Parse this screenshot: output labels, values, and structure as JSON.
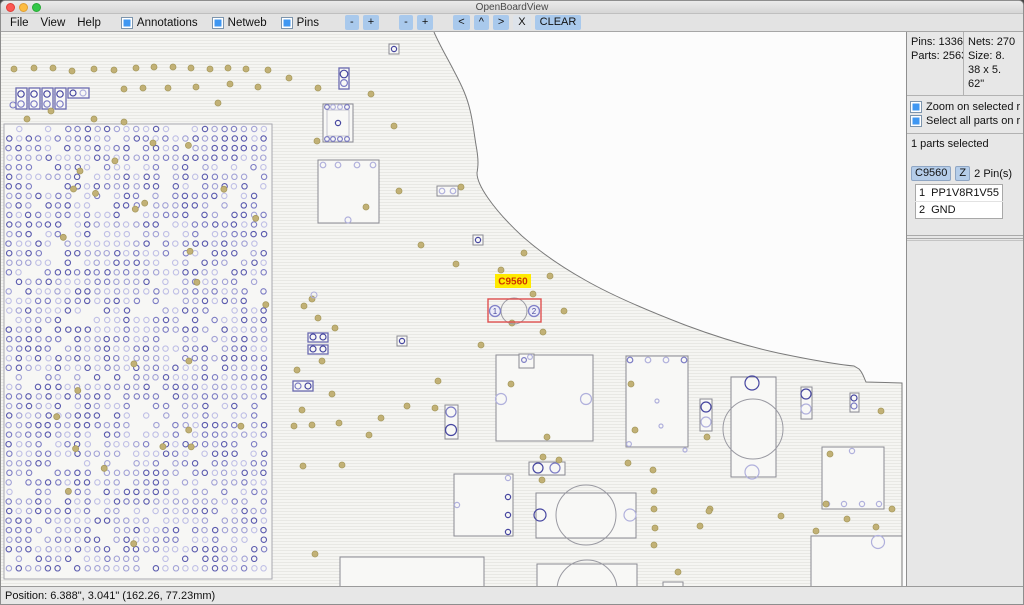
{
  "window": {
    "title": "OpenBoardView"
  },
  "menubar": {
    "menus": [
      "File",
      "View",
      "Help"
    ],
    "toggles": [
      {
        "label": "Annotations",
        "checked": true
      },
      {
        "label": "Netweb",
        "checked": true
      },
      {
        "label": "Pins",
        "checked": true
      }
    ],
    "buttons": [
      "-",
      "+",
      "-",
      "+",
      "<",
      "^",
      ">",
      "X",
      "CLEAR"
    ]
  },
  "sidebar": {
    "stats": {
      "pins": "Pins: 1336",
      "nets": "Nets: 270",
      "parts": "Parts: 2563",
      "size_lines": [
        "Size: 8.",
        "38 x 5.",
        "62\""
      ]
    },
    "options": [
      {
        "label": "Zoom on selected r",
        "checked": true
      },
      {
        "label": "Select all parts on r",
        "checked": true
      }
    ],
    "selection_summary": "1 parts selected",
    "part": {
      "name": "C9560",
      "zoom_button": "Z",
      "pin_count_label": "2 Pin(s)",
      "pins": [
        {
          "num": "1",
          "net": "PP1V8R1V55"
        },
        {
          "num": "2",
          "net": "GND"
        }
      ]
    }
  },
  "statusbar": {
    "position": "Position: 6.388\", 3.041\" (162.26, 77.23mm)"
  },
  "colors": {
    "accent_blue": "#3f97f2",
    "toolbar_button": "#a9c9ec",
    "selection_red": "#e05050",
    "label_yellow": "#ffea00",
    "label_text": "#cc3300",
    "via_fill": "#c2b176",
    "via_stroke": "#a79a5e"
  },
  "board": {
    "width": 905,
    "height": 556,
    "outside_bg": "#fcfcfc",
    "hatch": {
      "base": "#f5f5f2",
      "line": "#e8e8e4"
    },
    "edge_stroke": "#7a7a7a",
    "fill_path": "M0,0 L433,0 C439,14 447,27 453,39 C461,54 466,65 469,78 C472,90 473,101 475,113 C478,129 477,135 476,141 C476,148 480,156 487,166 C496,179 507,191 521,204 C538,219 559,234 584,248 C612,264 645,278 684,293 C716,305 745,314 777,321 C801,326 831,332 853,334 L858,337 C862,341 863,346 865,350 L901,351 L901,556 L0,556 Z",
    "edge_path": "M433,0 C439,14 447,27 453,39 C461,54 466,65 469,78 C472,90 473,101 475,113 C478,129 477,135 476,141 C476,148 480,156 487,166 C496,179 507,191 521,204 C538,219 559,234 584,248 C612,264 645,278 684,293 C716,305 745,314 777,321 C801,326 831,332 853,334 L858,337 C862,341 863,346 865,350 L901,351 L901,556",
    "shade_colors": {
      "d": "#4646a0",
      "m": "#7c7cc4",
      "l": "#b0b0dc",
      "g": "#9a9aa2"
    },
    "component_fill": "#f8f8f6",
    "component_stroke_gray": "#8a8a93",
    "component_stroke_blue": "#6a6ab0",
    "bga": {
      "x": 3,
      "y": 92,
      "w": 268,
      "h": 455,
      "cols": 27,
      "rows": 47,
      "sx": 9.8,
      "sy": 9.55,
      "r": 2.7,
      "skip": 0.16,
      "seed": 1234,
      "via_count": 24,
      "fill": "#f7f7f5",
      "stroke": "#a8a8b0",
      "grid_colors": [
        "#5a5aae",
        "#7d7dc4",
        "#a2a2d6",
        "#c0c0e6"
      ]
    },
    "components": [
      {
        "x": 15,
        "y": 56,
        "w": 11,
        "h": 21,
        "b": "blue",
        "circles": [
          [
            20,
            62,
            3.2,
            "d"
          ],
          [
            20,
            72,
            3.2,
            "m"
          ]
        ]
      },
      {
        "x": 28,
        "y": 56,
        "w": 11,
        "h": 21,
        "b": "blue",
        "circles": [
          [
            33,
            62,
            3.2,
            "d"
          ],
          [
            33,
            72,
            3.2,
            "m"
          ]
        ]
      },
      {
        "x": 41,
        "y": 56,
        "w": 11,
        "h": 21,
        "b": "blue",
        "circles": [
          [
            46,
            62,
            3.2,
            "d"
          ],
          [
            46,
            72,
            3.2,
            "m"
          ]
        ]
      },
      {
        "x": 54,
        "y": 56,
        "w": 11,
        "h": 21,
        "b": "blue",
        "circles": [
          [
            59,
            62,
            3.2,
            "d"
          ],
          [
            59,
            72,
            3.2,
            "m"
          ]
        ]
      },
      {
        "x": 67,
        "y": 56,
        "w": 21,
        "h": 10,
        "b": "blue",
        "circles": [
          [
            72,
            61,
            3,
            "d"
          ],
          [
            82,
            61,
            3,
            "l"
          ]
        ]
      },
      {
        "x": 388,
        "y": 12,
        "w": 10,
        "h": 10,
        "b": "gray",
        "circles": [
          [
            393,
            17,
            2.6,
            "d"
          ]
        ]
      },
      {
        "x": 338,
        "y": 36,
        "w": 10,
        "h": 21,
        "b": "blue",
        "circles": [
          [
            343,
            42,
            3.8,
            "d"
          ],
          [
            343,
            51,
            3.4,
            "m"
          ]
        ]
      },
      {
        "x": 322,
        "y": 72,
        "w": 30,
        "h": 38,
        "b": "gray",
        "inner": true,
        "circles": [
          [
            326,
            75,
            2.4,
            "m"
          ],
          [
            332,
            75,
            2.4,
            "l"
          ],
          [
            339,
            75,
            2.4,
            "l"
          ],
          [
            346,
            75,
            2.4,
            "m"
          ],
          [
            337,
            91,
            2.6,
            "d"
          ],
          [
            326,
            107,
            2.4,
            "m"
          ],
          [
            332,
            107,
            2.4,
            "m"
          ],
          [
            339,
            107,
            2.4,
            "m"
          ],
          [
            346,
            107,
            2.4,
            "m"
          ]
        ]
      },
      {
        "x": 317,
        "y": 128,
        "w": 61,
        "h": 63,
        "b": "gray",
        "circles": [
          [
            322,
            133,
            2.8,
            "l"
          ],
          [
            337,
            133,
            2.8,
            "l"
          ],
          [
            356,
            133,
            2.8,
            "l"
          ],
          [
            372,
            133,
            2.8,
            "l"
          ],
          [
            347,
            188,
            3,
            "l"
          ]
        ]
      },
      {
        "x": 436,
        "y": 154,
        "w": 21,
        "h": 10,
        "b": "gray",
        "circles": [
          [
            441,
            159,
            2.8,
            "l"
          ],
          [
            452,
            159,
            2.8,
            "l"
          ]
        ]
      },
      {
        "x": 472,
        "y": 203,
        "w": 10,
        "h": 10,
        "b": "gray",
        "circles": [
          [
            477,
            208,
            2.6,
            "d"
          ]
        ]
      },
      {
        "x": 307,
        "y": 301,
        "w": 20,
        "h": 9,
        "b": "blue",
        "circles": [
          [
            312,
            305,
            3,
            "d"
          ],
          [
            322,
            305,
            3,
            "d"
          ]
        ]
      },
      {
        "x": 307,
        "y": 313,
        "w": 20,
        "h": 9,
        "b": "blue",
        "circles": [
          [
            312,
            317,
            3,
            "d"
          ],
          [
            322,
            317,
            3,
            "d"
          ]
        ]
      },
      {
        "x": 396,
        "y": 304,
        "w": 10,
        "h": 10,
        "b": "gray",
        "circles": [
          [
            401,
            309,
            2.6,
            "d"
          ]
        ]
      },
      {
        "x": 292,
        "y": 349,
        "w": 20,
        "h": 10,
        "b": "blue",
        "circles": [
          [
            297,
            354,
            3,
            "m"
          ],
          [
            307,
            354,
            3,
            "d"
          ]
        ]
      },
      {
        "x": 444,
        "y": 373,
        "w": 13,
        "h": 34,
        "b": "gray",
        "circles": [
          [
            450,
            380,
            5,
            "m"
          ],
          [
            450,
            398,
            5.5,
            "d"
          ]
        ]
      },
      {
        "x": 495,
        "y": 323,
        "w": 97,
        "h": 86,
        "b": "gray",
        "circles": [
          [
            500,
            367,
            5.5,
            "l"
          ],
          [
            585,
            367,
            5.5,
            "l"
          ]
        ]
      },
      {
        "x": 518,
        "y": 322,
        "w": 15,
        "h": 14,
        "b": "gray",
        "circles": [
          [
            523,
            328,
            2.4,
            "m"
          ],
          [
            529,
            325,
            2.4,
            "l"
          ]
        ]
      },
      {
        "x": 625,
        "y": 324,
        "w": 62,
        "h": 91,
        "b": "gray",
        "circles": [
          [
            629,
            328,
            2.8,
            "m"
          ],
          [
            647,
            328,
            2.8,
            "l"
          ],
          [
            665,
            328,
            2.8,
            "l"
          ],
          [
            683,
            328,
            2.8,
            "m"
          ],
          [
            656,
            369,
            2,
            "l"
          ],
          [
            660,
            394,
            2,
            "l"
          ],
          [
            628,
            412,
            2.4,
            "l"
          ],
          [
            684,
            418,
            2,
            "l"
          ]
        ]
      },
      {
        "x": 528,
        "y": 430,
        "w": 36,
        "h": 13,
        "b": "gray",
        "circles": [
          [
            537,
            436,
            5,
            "d"
          ],
          [
            554,
            436,
            5,
            "m"
          ]
        ]
      },
      {
        "x": 453,
        "y": 442,
        "w": 59,
        "h": 62,
        "b": "gray",
        "circles": [
          [
            507,
            446,
            2.6,
            "l"
          ],
          [
            507,
            465,
            2.6,
            "d"
          ],
          [
            507,
            483,
            2.6,
            "d"
          ],
          [
            507,
            500,
            2.6,
            "d"
          ],
          [
            456,
            473,
            2.6,
            "l"
          ]
        ]
      },
      {
        "x": 535,
        "y": 461,
        "w": 100,
        "h": 45,
        "b": "gray",
        "big": [
          [
            585,
            483,
            30
          ]
        ],
        "circles": [
          [
            539,
            483,
            6,
            "d"
          ],
          [
            629,
            483,
            6,
            "l"
          ]
        ]
      },
      {
        "x": 339,
        "y": 525,
        "w": 144,
        "h": 31,
        "b": "gray"
      },
      {
        "x": 536,
        "y": 532,
        "w": 100,
        "h": 24,
        "b": "gray",
        "big": [
          [
            586,
            558,
            30
          ]
        ]
      },
      {
        "x": 662,
        "y": 550,
        "w": 20,
        "h": 6,
        "b": "gray"
      },
      {
        "x": 699,
        "y": 367,
        "w": 12,
        "h": 32,
        "b": "gray",
        "circles": [
          [
            705,
            375,
            5,
            "d"
          ],
          [
            705,
            390,
            5,
            "l"
          ]
        ]
      },
      {
        "x": 730,
        "y": 345,
        "w": 45,
        "h": 100,
        "b": "gray",
        "big": [
          [
            752,
            397,
            30
          ]
        ],
        "circles": [
          [
            751,
            351,
            7,
            "d"
          ],
          [
            751,
            440,
            7,
            "l"
          ]
        ]
      },
      {
        "x": 800,
        "y": 355,
        "w": 11,
        "h": 32,
        "b": "gray",
        "circles": [
          [
            805,
            362,
            5,
            "d"
          ],
          [
            805,
            377,
            5,
            "l"
          ]
        ]
      },
      {
        "x": 849,
        "y": 361,
        "w": 9,
        "h": 19,
        "b": "gray",
        "circles": [
          [
            853,
            366,
            3,
            "d"
          ],
          [
            853,
            374,
            3,
            "m"
          ]
        ]
      },
      {
        "x": 821,
        "y": 415,
        "w": 62,
        "h": 62,
        "b": "gray",
        "circles": [
          [
            851,
            419,
            2.6,
            "l"
          ],
          [
            826,
            472,
            2.6,
            "l"
          ],
          [
            843,
            472,
            2.6,
            "l"
          ],
          [
            861,
            472,
            2.6,
            "l"
          ],
          [
            878,
            472,
            2.6,
            "l"
          ]
        ]
      },
      {
        "x": 810,
        "y": 504,
        "w": 91,
        "h": 52,
        "b": "gray",
        "circles": [
          [
            877,
            510,
            6.5,
            "l"
          ]
        ]
      }
    ],
    "vias": [
      [
        13,
        37
      ],
      [
        33,
        36
      ],
      [
        52,
        36
      ],
      [
        71,
        39
      ],
      [
        93,
        37
      ],
      [
        113,
        38
      ],
      [
        135,
        36
      ],
      [
        153,
        35
      ],
      [
        172,
        35
      ],
      [
        190,
        36
      ],
      [
        209,
        37
      ],
      [
        227,
        36
      ],
      [
        245,
        37
      ],
      [
        267,
        38
      ],
      [
        288,
        46
      ],
      [
        123,
        57
      ],
      [
        142,
        56
      ],
      [
        167,
        56
      ],
      [
        195,
        55
      ],
      [
        229,
        52
      ],
      [
        257,
        55
      ],
      [
        317,
        56
      ],
      [
        370,
        62
      ],
      [
        217,
        71
      ],
      [
        50,
        79
      ],
      [
        26,
        87
      ],
      [
        93,
        87
      ],
      [
        123,
        90
      ],
      [
        152,
        111
      ],
      [
        79,
        139
      ],
      [
        393,
        94
      ],
      [
        316,
        109
      ],
      [
        398,
        159
      ],
      [
        460,
        155
      ],
      [
        365,
        175
      ],
      [
        420,
        213
      ],
      [
        455,
        232
      ],
      [
        500,
        238
      ],
      [
        523,
        221
      ],
      [
        549,
        244
      ],
      [
        532,
        262
      ],
      [
        563,
        279
      ],
      [
        511,
        291
      ],
      [
        542,
        300
      ],
      [
        480,
        313
      ],
      [
        311,
        267
      ],
      [
        303,
        274
      ],
      [
        317,
        286
      ],
      [
        334,
        296
      ],
      [
        321,
        329
      ],
      [
        296,
        338
      ],
      [
        331,
        362
      ],
      [
        437,
        349
      ],
      [
        301,
        378
      ],
      [
        293,
        394
      ],
      [
        311,
        393
      ],
      [
        338,
        391
      ],
      [
        368,
        403
      ],
      [
        380,
        386
      ],
      [
        406,
        374
      ],
      [
        434,
        376
      ],
      [
        510,
        352
      ],
      [
        546,
        405
      ],
      [
        630,
        352
      ],
      [
        634,
        398
      ],
      [
        627,
        431
      ],
      [
        652,
        438
      ],
      [
        653,
        459
      ],
      [
        653,
        477
      ],
      [
        654,
        496
      ],
      [
        653,
        513
      ],
      [
        677,
        540
      ],
      [
        699,
        494
      ],
      [
        709,
        477
      ],
      [
        780,
        484
      ],
      [
        815,
        499
      ],
      [
        846,
        487
      ],
      [
        875,
        495
      ],
      [
        891,
        477
      ],
      [
        880,
        379
      ],
      [
        706,
        405
      ],
      [
        708,
        479
      ],
      [
        829,
        422
      ],
      [
        825,
        472
      ],
      [
        302,
        434
      ],
      [
        314,
        522
      ],
      [
        341,
        433
      ],
      [
        542,
        425
      ],
      [
        541,
        448
      ],
      [
        558,
        428
      ]
    ],
    "scatter_pins": [
      [
        12,
        73,
        "m"
      ],
      [
        313,
        263,
        "l"
      ]
    ],
    "selection": {
      "label": "C9560",
      "label_rect": [
        494,
        242,
        36,
        14
      ],
      "rect": [
        487,
        267,
        53,
        23
      ],
      "body_circle": [
        513,
        279,
        13
      ],
      "pins": [
        {
          "n": "1",
          "cx": 494,
          "cy": 279
        },
        {
          "n": "2",
          "cx": 533,
          "cy": 279
        }
      ]
    }
  }
}
